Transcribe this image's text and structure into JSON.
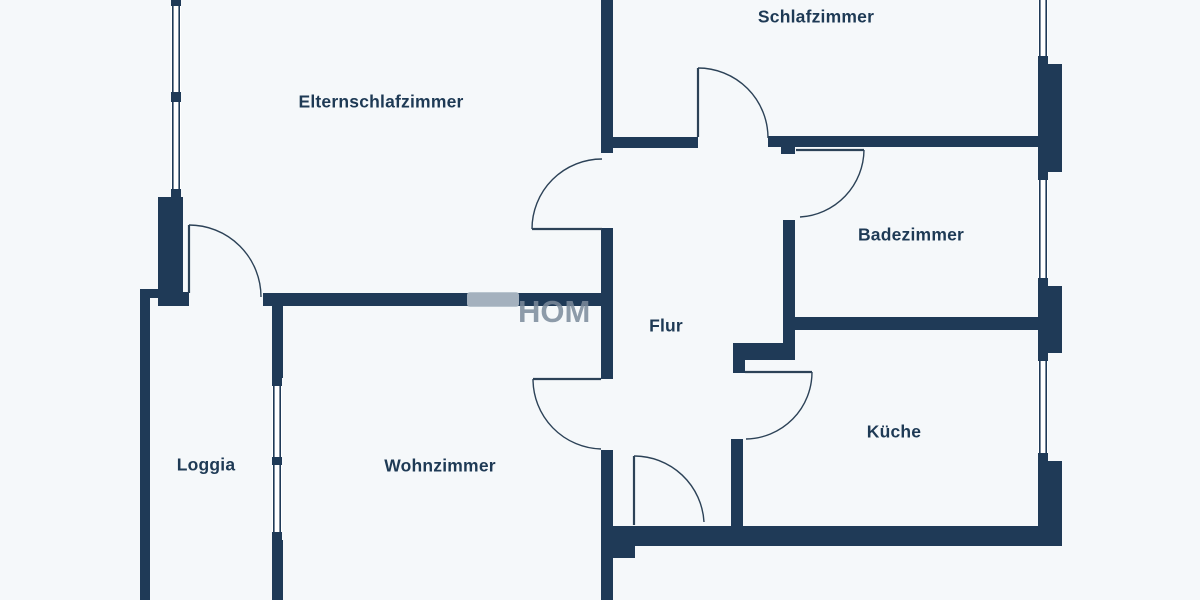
{
  "canvas": {
    "width": 1200,
    "height": 600,
    "bg": "#f5f8fa",
    "wall_color": "#1f3a57",
    "door_line_color": "#2c4257",
    "label_color": "#1e3a55",
    "label_size": 17.5,
    "watermark_text_color": "#7c8b9c",
    "watermark_pill_color": "#b3bfca"
  },
  "title": "Wohnung Grundriss",
  "rooms": [
    {
      "id": "elternschlafzimmer",
      "label": "Elternschlafzimmer",
      "x": 381,
      "y": 103
    },
    {
      "id": "schlafzimmer",
      "label": "Schlafzimmer",
      "x": 816,
      "y": 18
    },
    {
      "id": "badezimmer",
      "label": "Badezimmer",
      "x": 911,
      "y": 236
    },
    {
      "id": "flur",
      "label": "Flur",
      "x": 666,
      "y": 327
    },
    {
      "id": "kueche",
      "label": "Küche",
      "x": 894,
      "y": 433
    },
    {
      "id": "loggia",
      "label": "Loggia",
      "x": 206,
      "y": 466
    },
    {
      "id": "wohnzimmer",
      "label": "Wohnzimmer",
      "x": 440,
      "y": 467
    }
  ],
  "watermark": {
    "text": "HOM",
    "x": 518,
    "y": 322,
    "font_size": 31,
    "pill": [
      467,
      292,
      52,
      15
    ]
  },
  "walls": [
    {
      "name": "left-window-pillar",
      "r": [
        158,
        197,
        25,
        97
      ]
    },
    {
      "name": "eltern-door-jamb",
      "r": [
        158,
        292,
        31,
        14
      ]
    },
    {
      "name": "loggia-left-top-stub",
      "r": [
        140,
        289,
        20,
        9
      ]
    },
    {
      "name": "loggia-west-wall",
      "r": [
        140,
        296,
        10,
        304
      ]
    },
    {
      "name": "eltern-south-wall",
      "r": [
        263,
        293,
        340,
        13
      ]
    },
    {
      "name": "spine-wall-upper",
      "r": [
        601,
        0,
        12,
        153
      ]
    },
    {
      "name": "spine-wall-mid",
      "r": [
        601,
        228,
        12,
        151
      ]
    },
    {
      "name": "spine-wall-lower",
      "r": [
        601,
        450,
        12,
        150
      ]
    },
    {
      "name": "south-wall",
      "r": [
        601,
        526,
        461,
        20
      ]
    },
    {
      "name": "entry-step",
      "r": [
        613,
        546,
        22,
        12
      ]
    },
    {
      "name": "schlaf-south-wall-west",
      "r": [
        613,
        137,
        85,
        11
      ]
    },
    {
      "name": "schlaf-south-wall-east",
      "r": [
        768,
        136,
        270,
        11
      ]
    },
    {
      "name": "bad-door-jamb",
      "r": [
        781,
        147,
        14,
        7
      ]
    },
    {
      "name": "flur-bad-wall",
      "r": [
        783,
        220,
        12,
        140
      ]
    },
    {
      "name": "flur-kueche-jog",
      "r": [
        745,
        343,
        50,
        17
      ]
    },
    {
      "name": "kueche-west-wall-upper",
      "r": [
        733,
        343,
        12,
        30
      ]
    },
    {
      "name": "kueche-west-wall-lower",
      "r": [
        731,
        439,
        12,
        87
      ]
    },
    {
      "name": "bad-kueche-wall",
      "r": [
        783,
        317,
        255,
        13
      ]
    },
    {
      "name": "east-pier-1",
      "r": [
        1038,
        64,
        24,
        108
      ]
    },
    {
      "name": "east-pier-2",
      "r": [
        1038,
        286,
        24,
        67
      ]
    },
    {
      "name": "east-pier-3",
      "r": [
        1038,
        461,
        24,
        85
      ]
    },
    {
      "name": "loggia-wohn-wall-upper",
      "r": [
        272,
        306,
        11,
        72
      ]
    },
    {
      "name": "loggia-wohn-wall-lower",
      "r": [
        272,
        540,
        11,
        60
      ]
    }
  ],
  "windows": [
    {
      "name": "eltern-west-window",
      "x": 172,
      "y": 0,
      "w": 8,
      "h": 197,
      "ticks": [
        [
          171,
          0,
          10,
          6
        ],
        [
          171,
          92,
          10,
          10
        ],
        [
          171,
          189,
          10,
          8
        ]
      ]
    },
    {
      "name": "schlaf-east-window",
      "x": 1039,
      "y": 0,
      "w": 8,
      "h": 64,
      "ticks": [
        [
          1038,
          56,
          10,
          8
        ]
      ]
    },
    {
      "name": "bad-east-window",
      "x": 1039,
      "y": 172,
      "w": 8,
      "h": 114,
      "ticks": [
        [
          1038,
          172,
          10,
          8
        ],
        [
          1038,
          278,
          10,
          8
        ]
      ]
    },
    {
      "name": "kueche-east-window",
      "x": 1039,
      "y": 353,
      "w": 8,
      "h": 108,
      "ticks": [
        [
          1038,
          353,
          10,
          8
        ],
        [
          1038,
          453,
          10,
          8
        ]
      ]
    },
    {
      "name": "loggia-window",
      "x": 273,
      "y": 378,
      "w": 8,
      "h": 162,
      "ticks": [
        [
          272,
          378,
          10,
          8
        ],
        [
          272,
          457,
          10,
          8
        ],
        [
          272,
          532,
          10,
          8
        ]
      ]
    }
  ],
  "doors": [
    {
      "name": "eltern-door",
      "leaf": [
        189,
        225,
        189,
        293
      ],
      "arc": "M 189 225 A 72 72 0 0 1 261 297"
    },
    {
      "name": "flur-eltern-door",
      "leaf": [
        532,
        229,
        602,
        229
      ],
      "arc": "M 532 229 A 70 70 0 0 1 602 159"
    },
    {
      "name": "schlaf-door",
      "leaf": [
        698,
        68,
        698,
        137
      ],
      "arc": "M 698 68 A 70 70 0 0 1 768 138"
    },
    {
      "name": "bad-door",
      "leaf": [
        796,
        150,
        864,
        150
      ],
      "arc": "M 864 150 A 68 68 0 0 1 800 217"
    },
    {
      "name": "kueche-door",
      "leaf": [
        745,
        372,
        812,
        372
      ],
      "arc": "M 812 372 A 67 67 0 0 1 746 439"
    },
    {
      "name": "wohn-door",
      "leaf": [
        533,
        379,
        601,
        379
      ],
      "arc": "M 533 379 A 70 70 0 0 0 601 449"
    },
    {
      "name": "flur-south-door",
      "leaf": [
        634,
        456,
        634,
        525
      ],
      "arc": "M 634 456 A 70 70 0 0 1 704 522"
    }
  ]
}
